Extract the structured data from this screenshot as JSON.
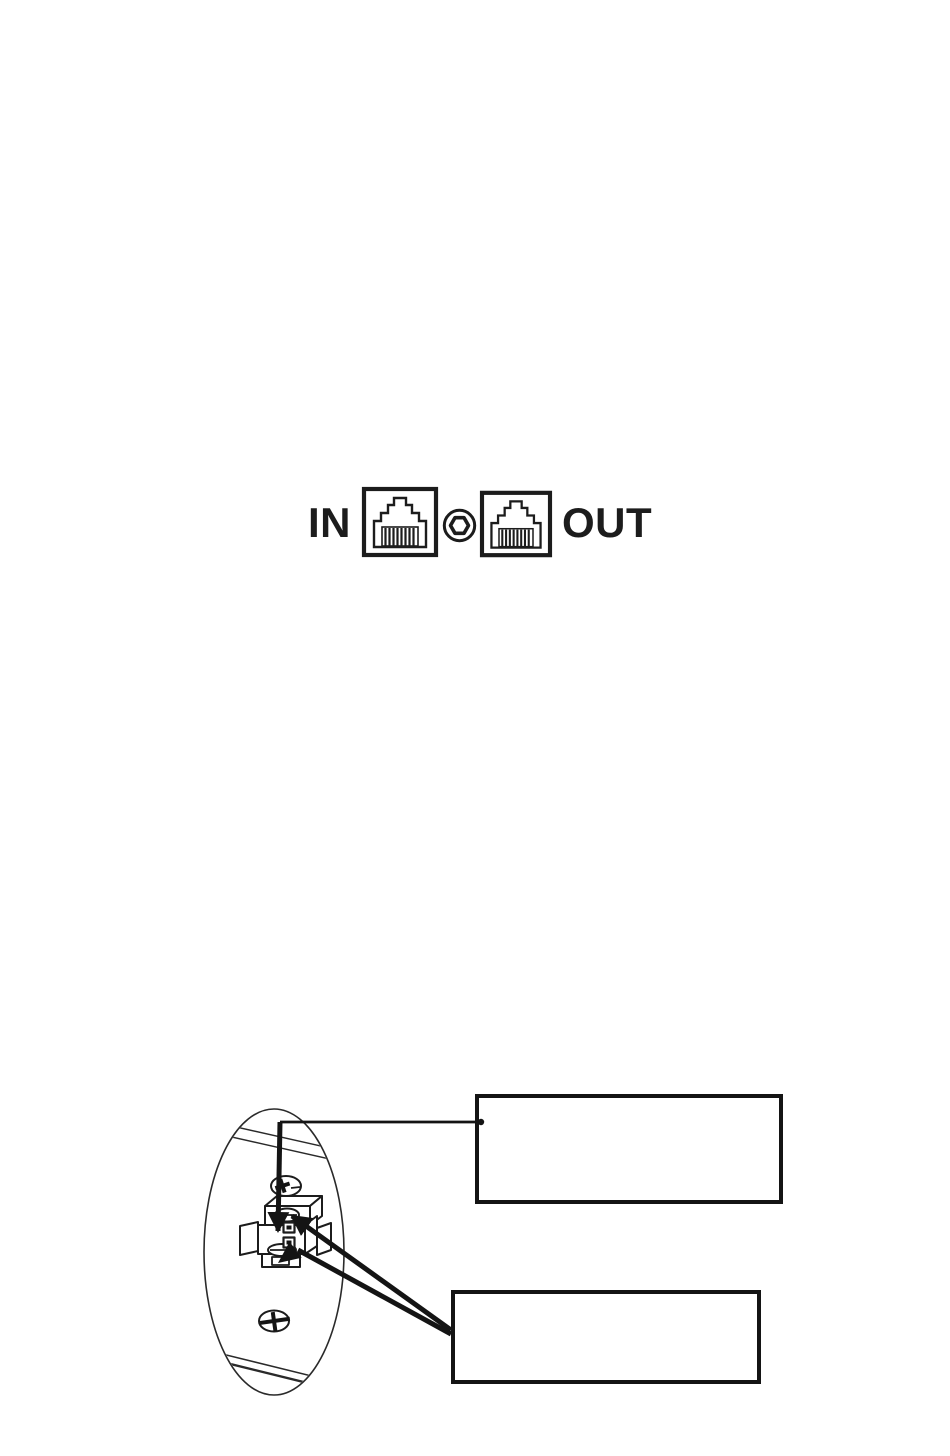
{
  "page": {
    "background": "#ffffff",
    "ink_color": "#1a1a1a"
  },
  "figure_rear_panel": {
    "label_in": "IN",
    "label_out": "OUT",
    "icons": [
      "rj45-in-port-icon",
      "jack-nut-icon",
      "rj45-out-port-icon"
    ]
  },
  "figure_device_bottom": {
    "icons": [
      "device-oval-outline",
      "phillips-screw-icon",
      "terminal-block-icon",
      "down-arrow-icon",
      "callout-arrow-icon"
    ],
    "callout_top_text": "",
    "callout_bottom_text": ""
  }
}
